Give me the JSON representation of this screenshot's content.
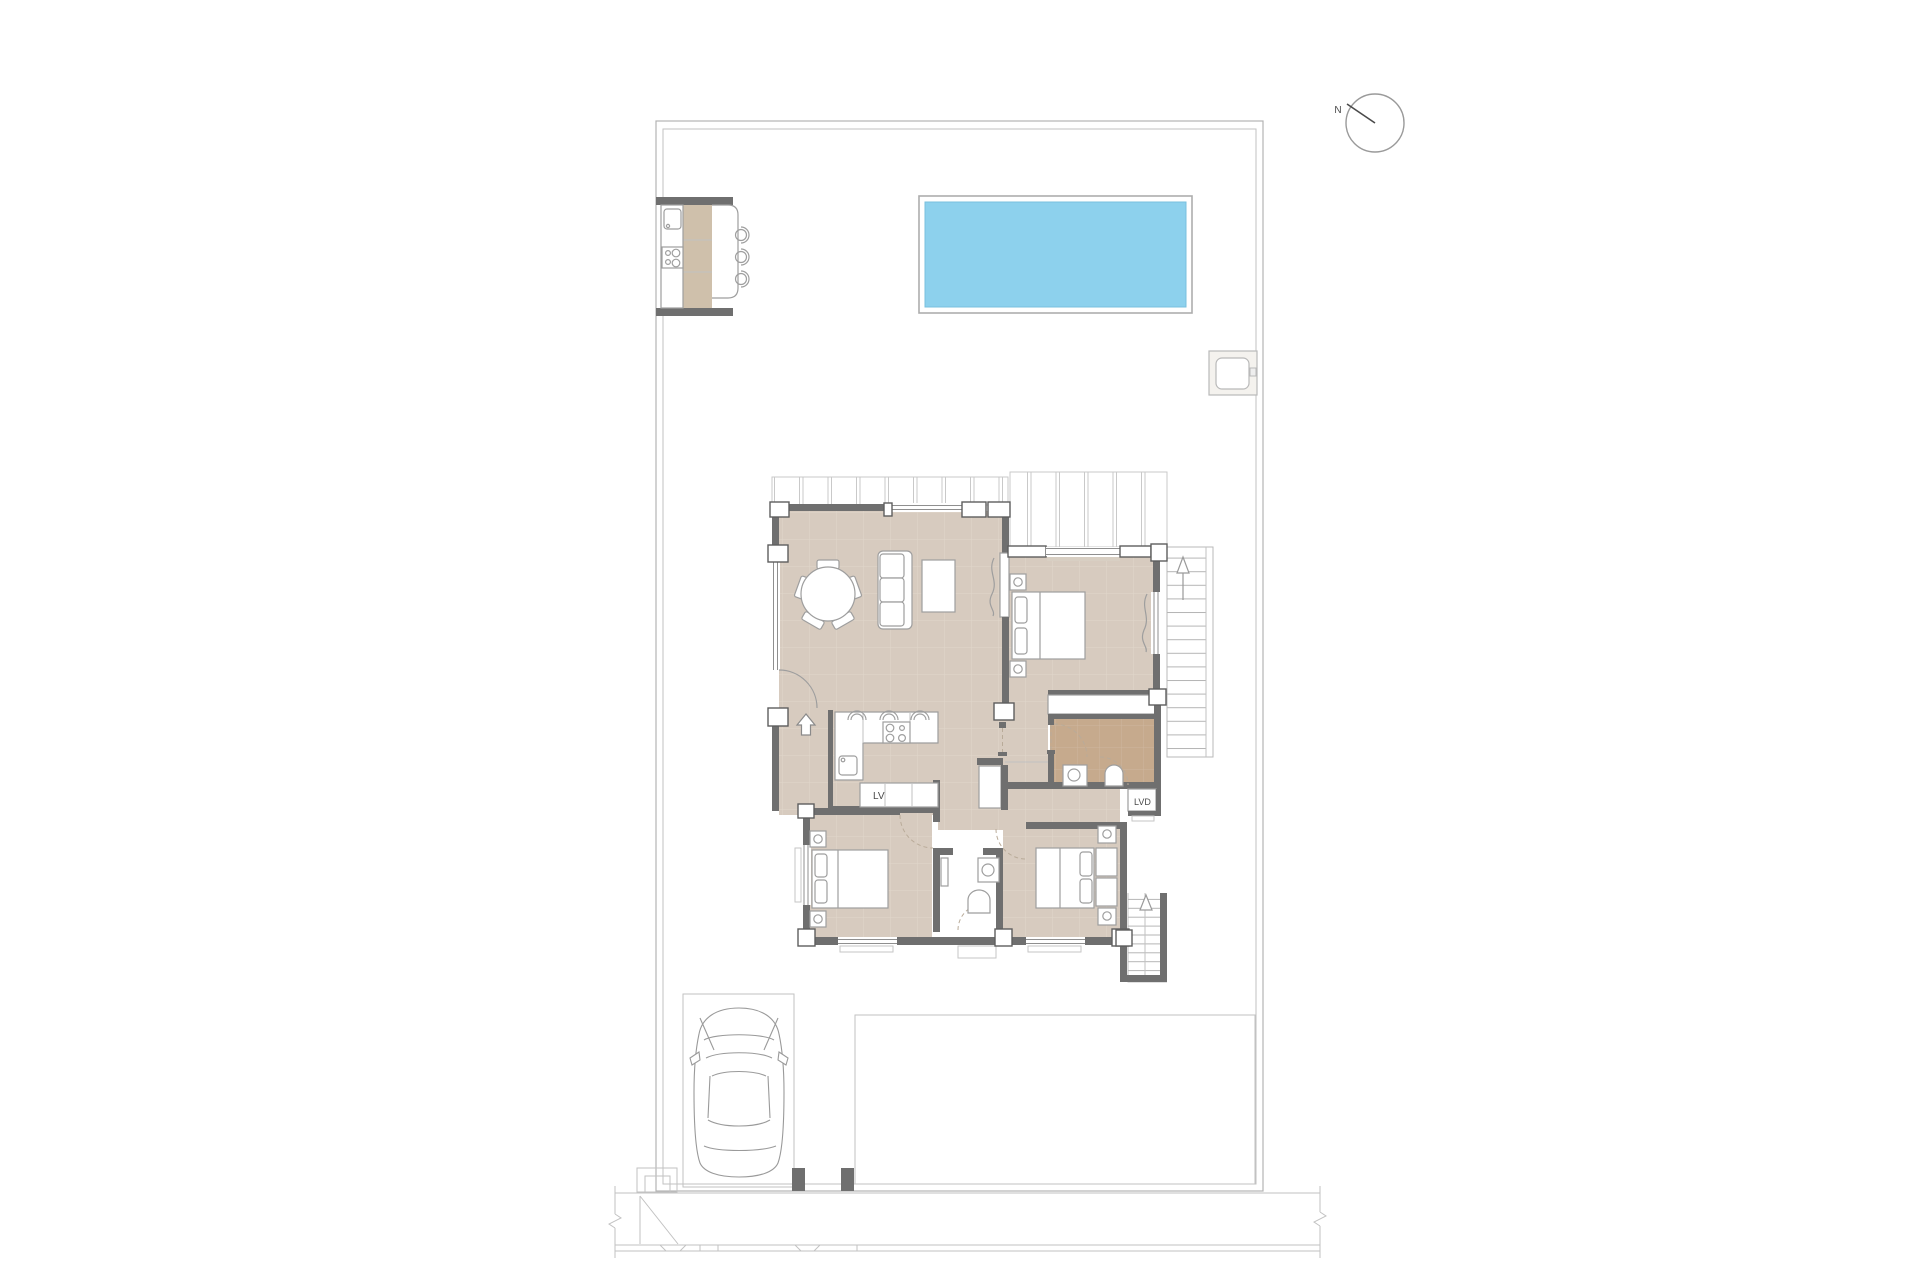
{
  "plan": {
    "labels": {
      "north_indicator": "N",
      "dishwasher": "LV",
      "washer": "LVD"
    },
    "colors": {
      "background": "#ffffff",
      "site_line": "#b3b3b3",
      "wall": "#6f6f6f",
      "furniture_line": "#9e9e9e",
      "floor": "#d7cbbf",
      "floor_grid": "#e1d7cb",
      "ensuite_floor": "#c6aa8d",
      "ensuite_grid": "#cfb79e",
      "counter_top": "#cfc0ab",
      "pool_water": "#8dd1ed",
      "pool_edge": "#79c0de",
      "text": "#4a4a4a"
    }
  }
}
